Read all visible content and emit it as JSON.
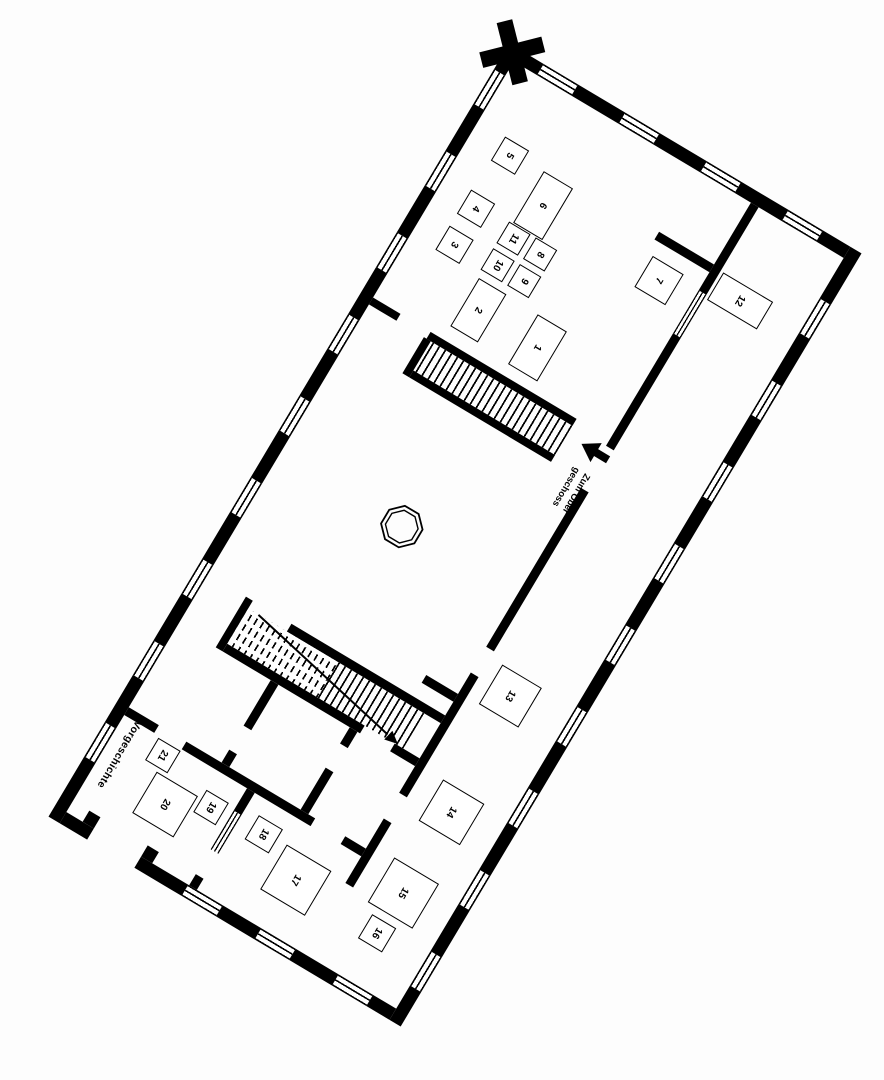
{
  "plan": {
    "type": "museum ground-floor plan, rotated scan, black ink on white",
    "colors": {
      "ink": "#000000",
      "paper": "#ffffff"
    }
  },
  "labels": {
    "to_upper_floor_line1": "Zum Ober",
    "to_upper_floor_line2": "geschoss",
    "prehistory_room": "Vorgeschichte"
  },
  "exhibit_boxes": [
    {
      "number": "1"
    },
    {
      "number": "2"
    },
    {
      "number": "3"
    },
    {
      "number": "4"
    },
    {
      "number": "5"
    },
    {
      "number": "6"
    },
    {
      "number": "7"
    },
    {
      "number": "8"
    },
    {
      "number": "9"
    },
    {
      "number": "10"
    },
    {
      "number": "11"
    },
    {
      "number": "12"
    },
    {
      "number": "13"
    },
    {
      "number": "14"
    },
    {
      "number": "15"
    },
    {
      "number": "16"
    },
    {
      "number": "17"
    },
    {
      "number": "18"
    },
    {
      "number": "19"
    },
    {
      "number": "20"
    },
    {
      "number": "21"
    }
  ]
}
